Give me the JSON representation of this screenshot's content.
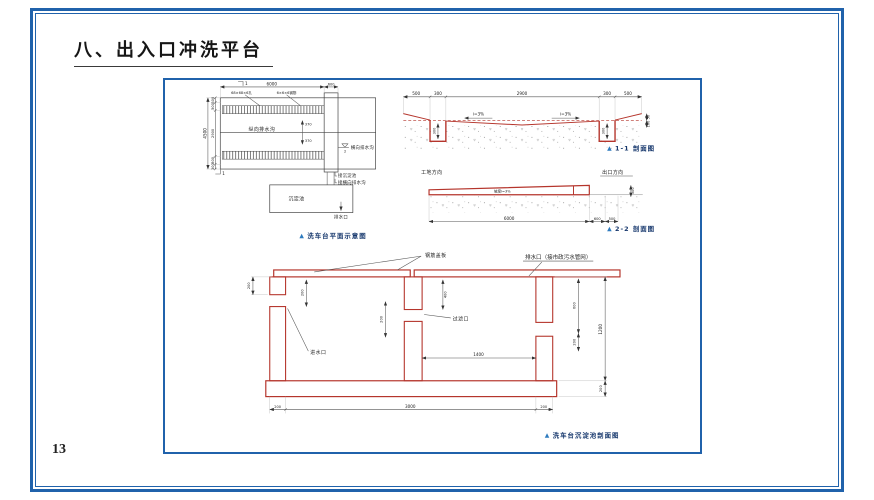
{
  "page": {
    "title": "八、出入口冲洗平台",
    "page_number": "13"
  },
  "ui": {
    "caption_marker": "▲"
  },
  "colors": {
    "frame_blue": "#2062ab",
    "drawing_red": "#b5352c",
    "caption_blue": "#2e7bbf"
  },
  "plan_view": {
    "caption": "洗车台平面示意图",
    "grating_left": "68×68×6孔",
    "grating_right": "6×6×6钢筋",
    "longitudinal_drain": "纵向排水沟",
    "transverse_drain": "横向排水沟",
    "to_tank": "接沉淀池",
    "to_transverse": "接横向排水沟",
    "tank": "沉淀池",
    "outlet": "排水口",
    "dim_top": "6000",
    "dim_strip": "600",
    "dim_left_total": "4500",
    "left_segs": [
      "300",
      "500",
      "2900",
      "500",
      "300"
    ],
    "offset_up": "370",
    "offset_down": "370",
    "mark1": "1",
    "mark2": "2"
  },
  "section_1_1": {
    "caption": "1-1 剖面图",
    "segs": [
      "500",
      "300",
      "2900",
      "300",
      "500"
    ],
    "slope": "i=3%",
    "depth": "300",
    "edge_top": "50",
    "edge_bottom": "100"
  },
  "section_2_2": {
    "caption": "2-2 剖面图",
    "site": "工地方向",
    "exit": "出口方向",
    "slope": "坡度i=3%",
    "dim_length": "6000",
    "dim_strip": "600",
    "dim_edge": "500",
    "dim_height": "300"
  },
  "tank_section": {
    "caption": "洗车台沉淀池剖面图",
    "cover": "钢筋盖板",
    "outlet": "排水口（接市政污水管网）",
    "filter": "过滤口",
    "inlet": "进水口",
    "dim_stub": "200",
    "dim_inlet_drop": "200",
    "dim_filter_drop": "200",
    "dim_baffle": "400",
    "dim_chamber": "1400",
    "right_top": "600",
    "right_mid": "200",
    "right_total": "1200",
    "floor_thk": "200",
    "bottom": [
      "200",
      "3000",
      "200"
    ]
  }
}
